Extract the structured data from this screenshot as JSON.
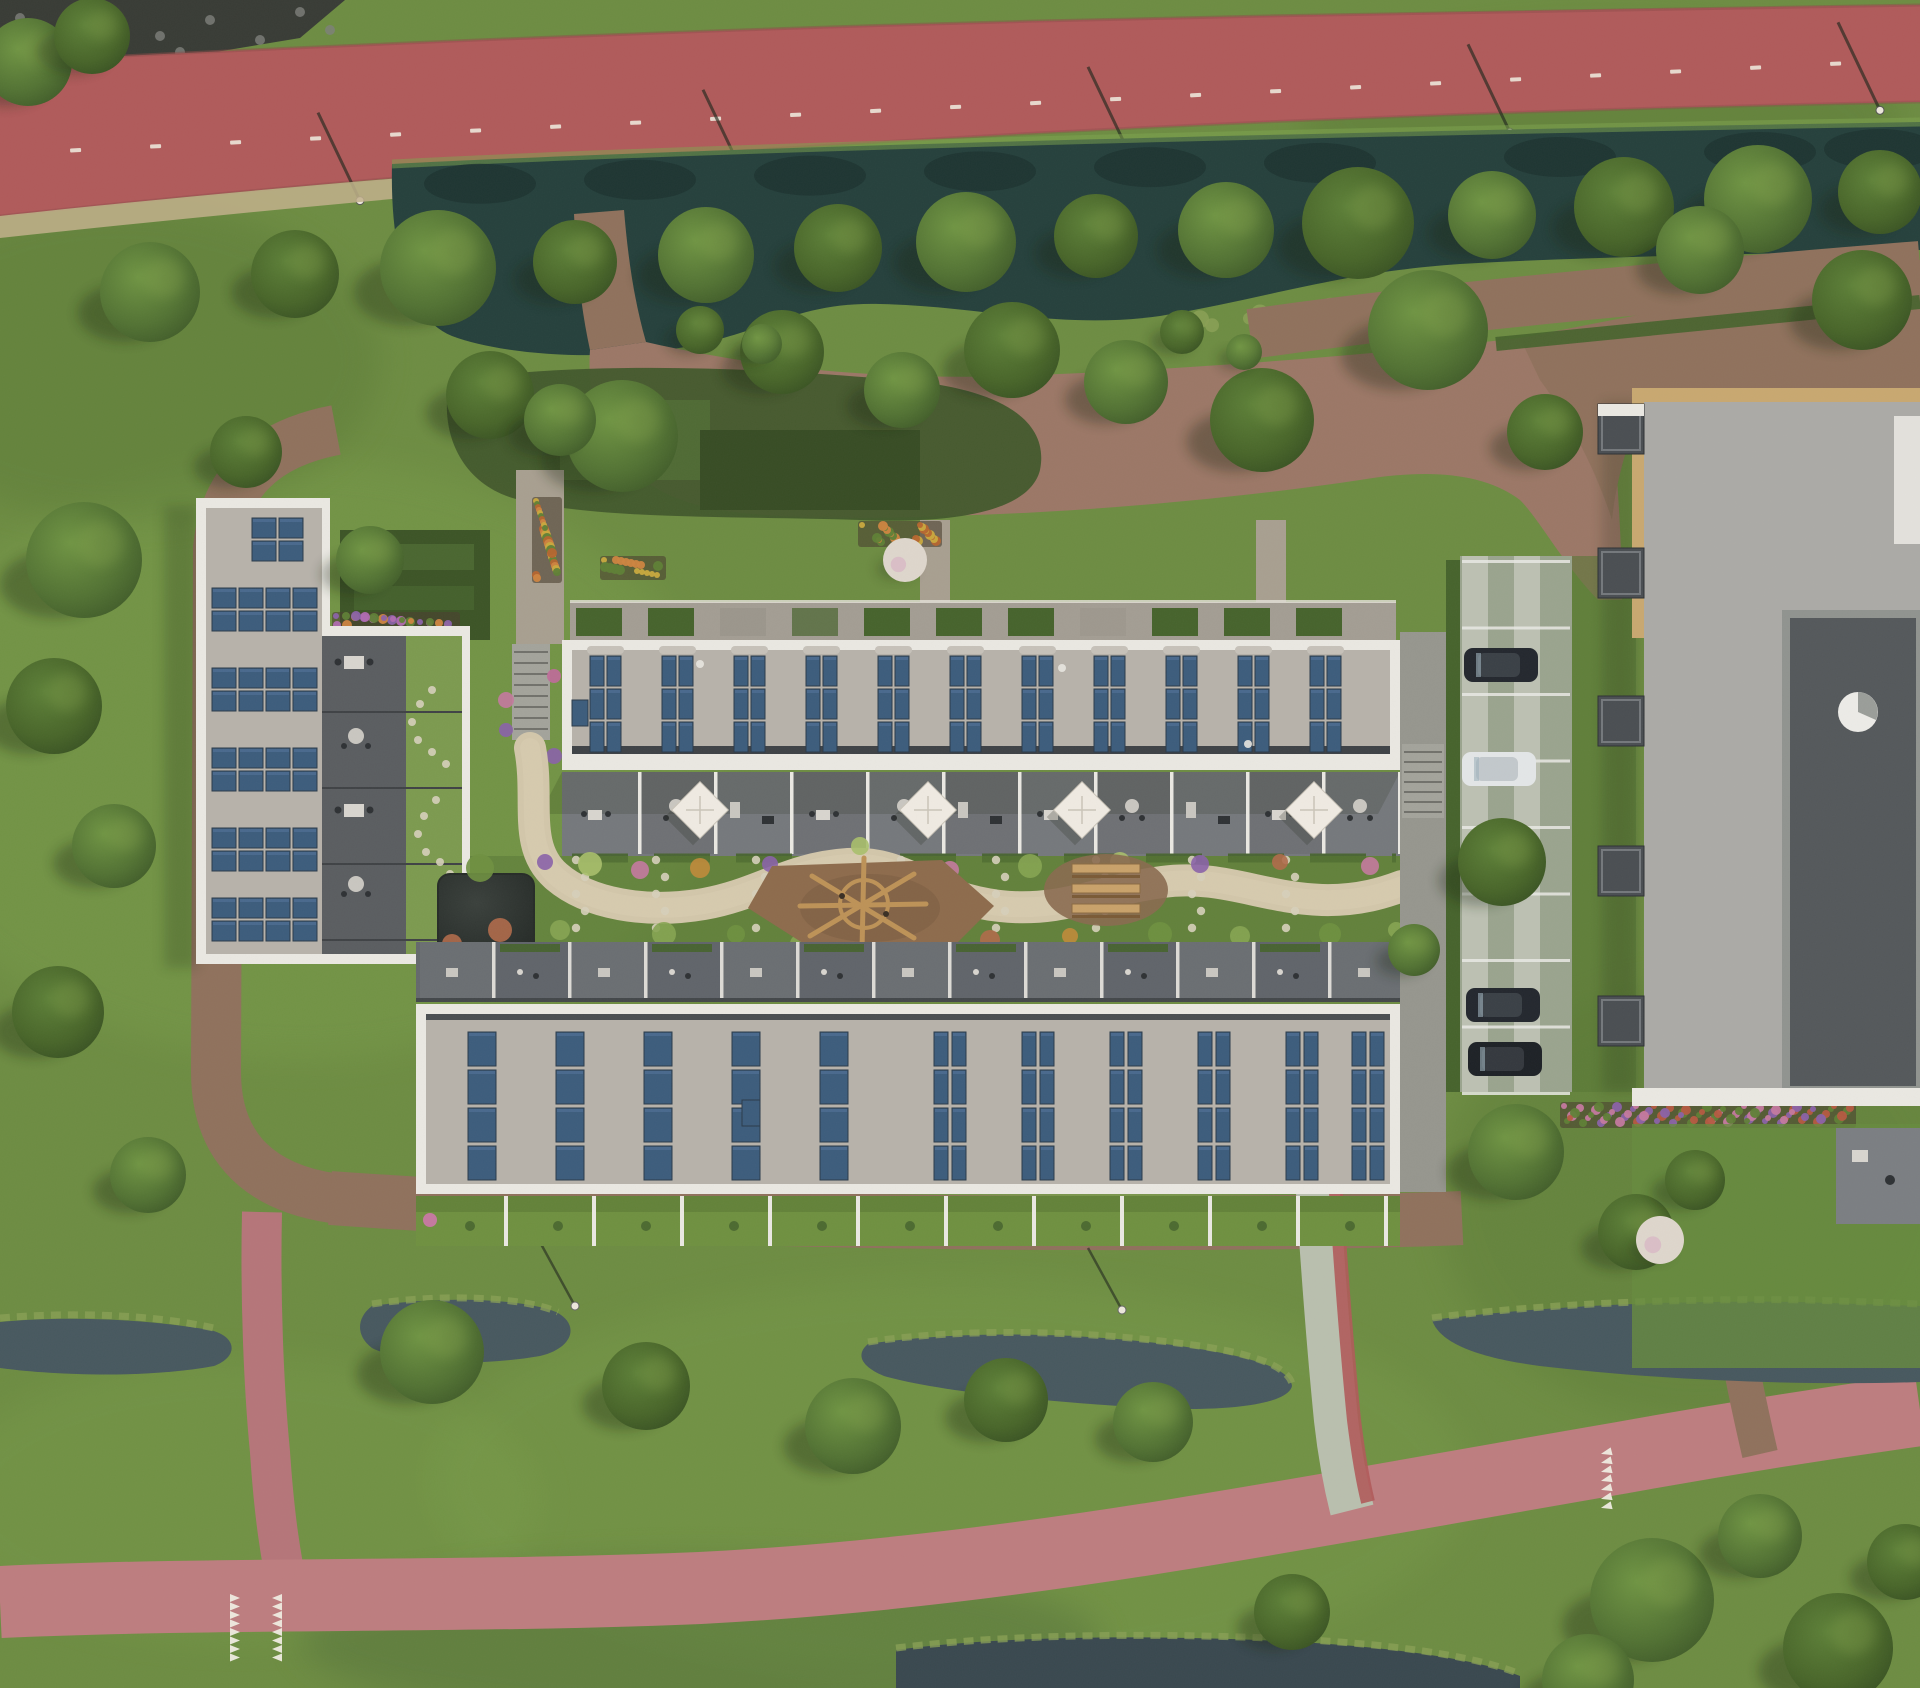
{
  "meta": {
    "description": "Aerial rendering of a residential courtyard block with solar panel roofs, canal, cycle path, gardens and parking"
  },
  "palette": {
    "grass": "#6d8c42",
    "grass_light": "#7ea34e",
    "grass_dark": "#587736",
    "tree_light": "#8aa84f",
    "tree_shadow": "#16230c",
    "water_canal": "#25403c",
    "water_canal_dark": "#1c322f",
    "water_ditch": "#47585f",
    "water_ditch_dark": "#39484f",
    "reed": "#8aa055",
    "path_red": "#b05a5a",
    "road_pink": "#bd7d7f",
    "road_pink_d": "#b57579",
    "dirt": "#8f715c",
    "dirt_dark": "#7d6150",
    "plaza": "#9b7766",
    "parapet": "#eae8e2",
    "roof_gravel": "#b7b2aa",
    "roof_dark": "#5a5d60",
    "terrace": "#75787c",
    "terrace_s": "#64686c",
    "solar": "#3c5c7c",
    "solar_light": "#54749a",
    "solar_frame": "#2a3a4a",
    "court_path": "#d2c6aa",
    "stone": "#d6cfba",
    "pond": "#313733",
    "sand_play": "#8d6b4c",
    "wood": "#c9a26a",
    "hedge": "#46632c",
    "parking_base": "#9aa48e",
    "paver_light": "#c2c6b8",
    "white_line": "#e9e9e4",
    "rb_roof": "#abaaa6",
    "rb_trim": "#c8a870",
    "rb_court": "#54585b"
  },
  "scene": {
    "trees": [
      [
        150,
        292,
        50
      ],
      [
        295,
        274,
        44
      ],
      [
        438,
        268,
        58
      ],
      [
        575,
        262,
        42
      ],
      [
        706,
        255,
        48
      ],
      [
        838,
        248,
        44
      ],
      [
        966,
        242,
        50
      ],
      [
        1096,
        236,
        42
      ],
      [
        1226,
        230,
        48
      ],
      [
        1358,
        223,
        56
      ],
      [
        1492,
        215,
        44
      ],
      [
        1624,
        207,
        50
      ],
      [
        1758,
        199,
        54
      ],
      [
        1880,
        192,
        42
      ],
      [
        28,
        62,
        44
      ],
      [
        92,
        36,
        38
      ],
      [
        622,
        436,
        56
      ],
      [
        782,
        352,
        42
      ],
      [
        902,
        390,
        38
      ],
      [
        1012,
        350,
        48
      ],
      [
        1126,
        382,
        42
      ],
      [
        1262,
        420,
        52
      ],
      [
        1428,
        330,
        60
      ],
      [
        1545,
        432,
        38
      ],
      [
        1700,
        250,
        44
      ],
      [
        1862,
        300,
        50
      ],
      [
        84,
        560,
        58
      ],
      [
        54,
        706,
        48
      ],
      [
        114,
        846,
        42
      ],
      [
        58,
        1012,
        46
      ],
      [
        148,
        1175,
        38
      ],
      [
        246,
        452,
        36
      ],
      [
        370,
        560,
        34
      ],
      [
        490,
        395,
        44
      ],
      [
        560,
        420,
        36
      ],
      [
        1502,
        862,
        44
      ],
      [
        1516,
        1152,
        48
      ],
      [
        1636,
        1232,
        38
      ],
      [
        1414,
        950,
        26
      ],
      [
        1695,
        1180,
        30
      ],
      [
        432,
        1352,
        52
      ],
      [
        646,
        1386,
        44
      ],
      [
        853,
        1426,
        48
      ],
      [
        1006,
        1400,
        42
      ],
      [
        1153,
        1422,
        40
      ],
      [
        1292,
        1612,
        38
      ],
      [
        1652,
        1600,
        62
      ],
      [
        1838,
        1648,
        55
      ],
      [
        1760,
        1536,
        42
      ],
      [
        1905,
        1562,
        38
      ],
      [
        1588,
        1680,
        46
      ],
      [
        700,
        330,
        24
      ],
      [
        762,
        344,
        20
      ],
      [
        1182,
        332,
        22
      ],
      [
        1244,
        352,
        18
      ]
    ],
    "blossoms": [
      [
        905,
        560,
        22
      ],
      [
        1660,
        1240,
        24
      ]
    ],
    "rocks": [
      [
        20,
        18
      ],
      [
        60,
        30
      ],
      [
        110,
        14
      ],
      [
        160,
        36
      ],
      [
        210,
        20
      ],
      [
        260,
        40
      ],
      [
        300,
        12
      ],
      [
        330,
        30
      ],
      [
        90,
        52
      ],
      [
        180,
        52
      ],
      [
        250,
        56
      ],
      [
        35,
        64
      ]
    ],
    "cycle": {
      "dash_count": 23,
      "lamp_xs": [
        360,
        745,
        1130,
        1510,
        1880
      ]
    },
    "canal_reflection_xs": [
      480,
      640,
      810,
      980,
      1150,
      1320,
      1560,
      1760,
      1880
    ],
    "canal_reed_xs": [
      1200,
      1260,
      1330,
      1400,
      1470,
      1550,
      1630,
      1710,
      1790,
      1870
    ],
    "solar": {
      "left_groups": [
        {
          "x": 252,
          "y": 518,
          "c": 2,
          "r": 2
        },
        {
          "x": 212,
          "y": 588,
          "c": 4,
          "r": 2
        },
        {
          "x": 212,
          "y": 668,
          "c": 4,
          "r": 2
        },
        {
          "x": 212,
          "y": 748,
          "c": 4,
          "r": 2
        },
        {
          "x": 212,
          "y": 828,
          "c": 4,
          "r": 2
        },
        {
          "x": 212,
          "y": 898,
          "c": 4,
          "r": 2
        }
      ],
      "left_panel": {
        "pw": 24,
        "ph": 20,
        "g": 3
      },
      "top_cols": {
        "x0": 590,
        "step": 72,
        "n": 11,
        "y": 656,
        "pw": 14,
        "ph": 30,
        "rows": 3,
        "cols": 2,
        "g": 3
      },
      "bottom_single": {
        "xs": [
          468,
          556,
          644,
          732,
          820
        ],
        "y": 1032,
        "pw": 28,
        "ph": 34,
        "rows": 4,
        "g": 4
      },
      "bottom_double": {
        "xs": [
          934,
          1022,
          1110,
          1198,
          1286,
          1352
        ],
        "y": 1032,
        "pw": 14,
        "ph": 34,
        "rows": 4,
        "cols": 2,
        "g": 4
      }
    },
    "parasol_xs": [
      700,
      928,
      1082,
      1314
    ],
    "terraces_top": {
      "x0": 562,
      "x1": 1400,
      "step": 76,
      "y": 772,
      "h": 82
    },
    "terraces_south": {
      "x0": 416,
      "x1": 1400,
      "step": 76,
      "y": 942,
      "h": 58
    },
    "gardens_north": {
      "x0": 570,
      "x1": 1396,
      "step": 72,
      "y": 604,
      "h": 36
    },
    "yards_south": {
      "x0": 416,
      "x1": 1400,
      "step": 88,
      "y": 1196,
      "h": 50
    },
    "left_terrace_ys": [
      656,
      730,
      804,
      878
    ],
    "left_seam_ys": [
      712,
      788,
      864,
      940
    ],
    "spiral_stones": [
      [
        432,
        690
      ],
      [
        420,
        704
      ],
      [
        412,
        722
      ],
      [
        418,
        740
      ],
      [
        432,
        752
      ],
      [
        446,
        764
      ],
      [
        436,
        800
      ],
      [
        424,
        816
      ],
      [
        418,
        834
      ],
      [
        426,
        852
      ],
      [
        440,
        862
      ],
      [
        450,
        874
      ]
    ],
    "parking": {
      "x": 1462,
      "w": 108,
      "y0": 560,
      "lines": 8,
      "dy": 66.5
    },
    "cars": [
      {
        "x": 1464,
        "y": 648,
        "t": "dark"
      },
      {
        "x": 1462,
        "y": 752,
        "t": "white"
      },
      {
        "x": 1466,
        "y": 988,
        "t": "dark"
      },
      {
        "x": 1468,
        "y": 1042,
        "t": "darker"
      }
    ],
    "balcony_ys": [
      404,
      548,
      696,
      846,
      996
    ],
    "beds": [
      {
        "x": 532,
        "y": 497,
        "w": 30,
        "h": 86,
        "colors": [
          "#c9a93e",
          "#cd8440",
          "#b5652f",
          "#5f7f36"
        ]
      },
      {
        "x": 600,
        "y": 556,
        "w": 66,
        "h": 24,
        "colors": [
          "#c9a93e",
          "#cd8440",
          "#5f7f36"
        ]
      },
      {
        "x": 858,
        "y": 521,
        "w": 84,
        "h": 26,
        "colors": [
          "#c9a93e",
          "#cd8440",
          "#b5652f",
          "#5f7f36"
        ]
      },
      {
        "x": 332,
        "y": 612,
        "w": 128,
        "h": 18,
        "colors": [
          "#8a62a8",
          "#b06ab0",
          "#5f7f36",
          "#cd8440"
        ]
      },
      {
        "x": 200,
        "y": 506,
        "w": 124,
        "h": 20,
        "colors": [
          "#c4799f",
          "#8a62a8",
          "#cd8440",
          "#5f7f36"
        ]
      },
      {
        "x": 200,
        "y": 936,
        "w": 256,
        "h": 20,
        "colors": [
          "#c4799f",
          "#cd8440",
          "#b55a41",
          "#86a452"
        ]
      },
      {
        "x": 1560,
        "y": 1102,
        "w": 296,
        "h": 26,
        "colors": [
          "#c4799f",
          "#8a62a8",
          "#b55a41",
          "#5f7f36"
        ]
      }
    ],
    "stair_flowers": [
      [
        506,
        700,
        8,
        "#c4799f"
      ],
      [
        506,
        730,
        7,
        "#8a62a8"
      ],
      [
        554,
        676,
        7,
        "#c06a9a"
      ],
      [
        554,
        756,
        8,
        "#8a62a8"
      ],
      [
        530,
        748,
        6,
        "#b06ab0"
      ]
    ],
    "court_plants": [
      [
        480,
        868,
        14,
        0
      ],
      [
        500,
        930,
        12,
        3
      ],
      [
        560,
        930,
        10,
        1
      ],
      [
        590,
        864,
        12,
        2
      ],
      [
        640,
        870,
        9,
        5
      ],
      [
        664,
        934,
        12,
        1
      ],
      [
        700,
        868,
        10,
        4
      ],
      [
        736,
        934,
        9,
        0
      ],
      [
        770,
        864,
        8,
        6
      ],
      [
        800,
        944,
        10,
        1
      ],
      [
        860,
        846,
        9,
        2
      ],
      [
        910,
        934,
        12,
        0
      ],
      [
        950,
        870,
        9,
        5
      ],
      [
        990,
        940,
        10,
        3
      ],
      [
        1030,
        866,
        12,
        1
      ],
      [
        1070,
        936,
        8,
        4
      ],
      [
        1120,
        862,
        10,
        2
      ],
      [
        1160,
        934,
        12,
        0
      ],
      [
        1200,
        864,
        9,
        6
      ],
      [
        1240,
        936,
        10,
        1
      ],
      [
        1280,
        862,
        8,
        3
      ],
      [
        1330,
        934,
        11,
        0
      ],
      [
        1370,
        866,
        9,
        5
      ],
      [
        1396,
        930,
        8,
        1
      ],
      [
        452,
        944,
        10,
        3
      ],
      [
        545,
        862,
        8,
        6
      ]
    ],
    "plant_colors": [
      "#6f9040",
      "#86a452",
      "#a9bf6b",
      "#b06a4a",
      "#c08a3a",
      "#c4799f",
      "#8a62a8"
    ],
    "stones_cols": [
      580,
      660,
      760,
      905,
      1000,
      1100,
      1196,
      1290
    ],
    "playground_logs": {
      "x0": 804,
      "y": 944,
      "n": 6,
      "dx": 20
    },
    "picnic_bench_ys": [
      864,
      884,
      904
    ],
    "teeth": {
      "g1x": [
        230,
        272
      ],
      "g1y": 1594,
      "g1n": 8,
      "g1dy": 8.5,
      "g2x": 1600,
      "g2y": 1450,
      "g2n": 7,
      "g2dy": 9
    },
    "road_lamps": [
      [
        575,
        1306
      ],
      [
        1122,
        1310
      ]
    ]
  }
}
